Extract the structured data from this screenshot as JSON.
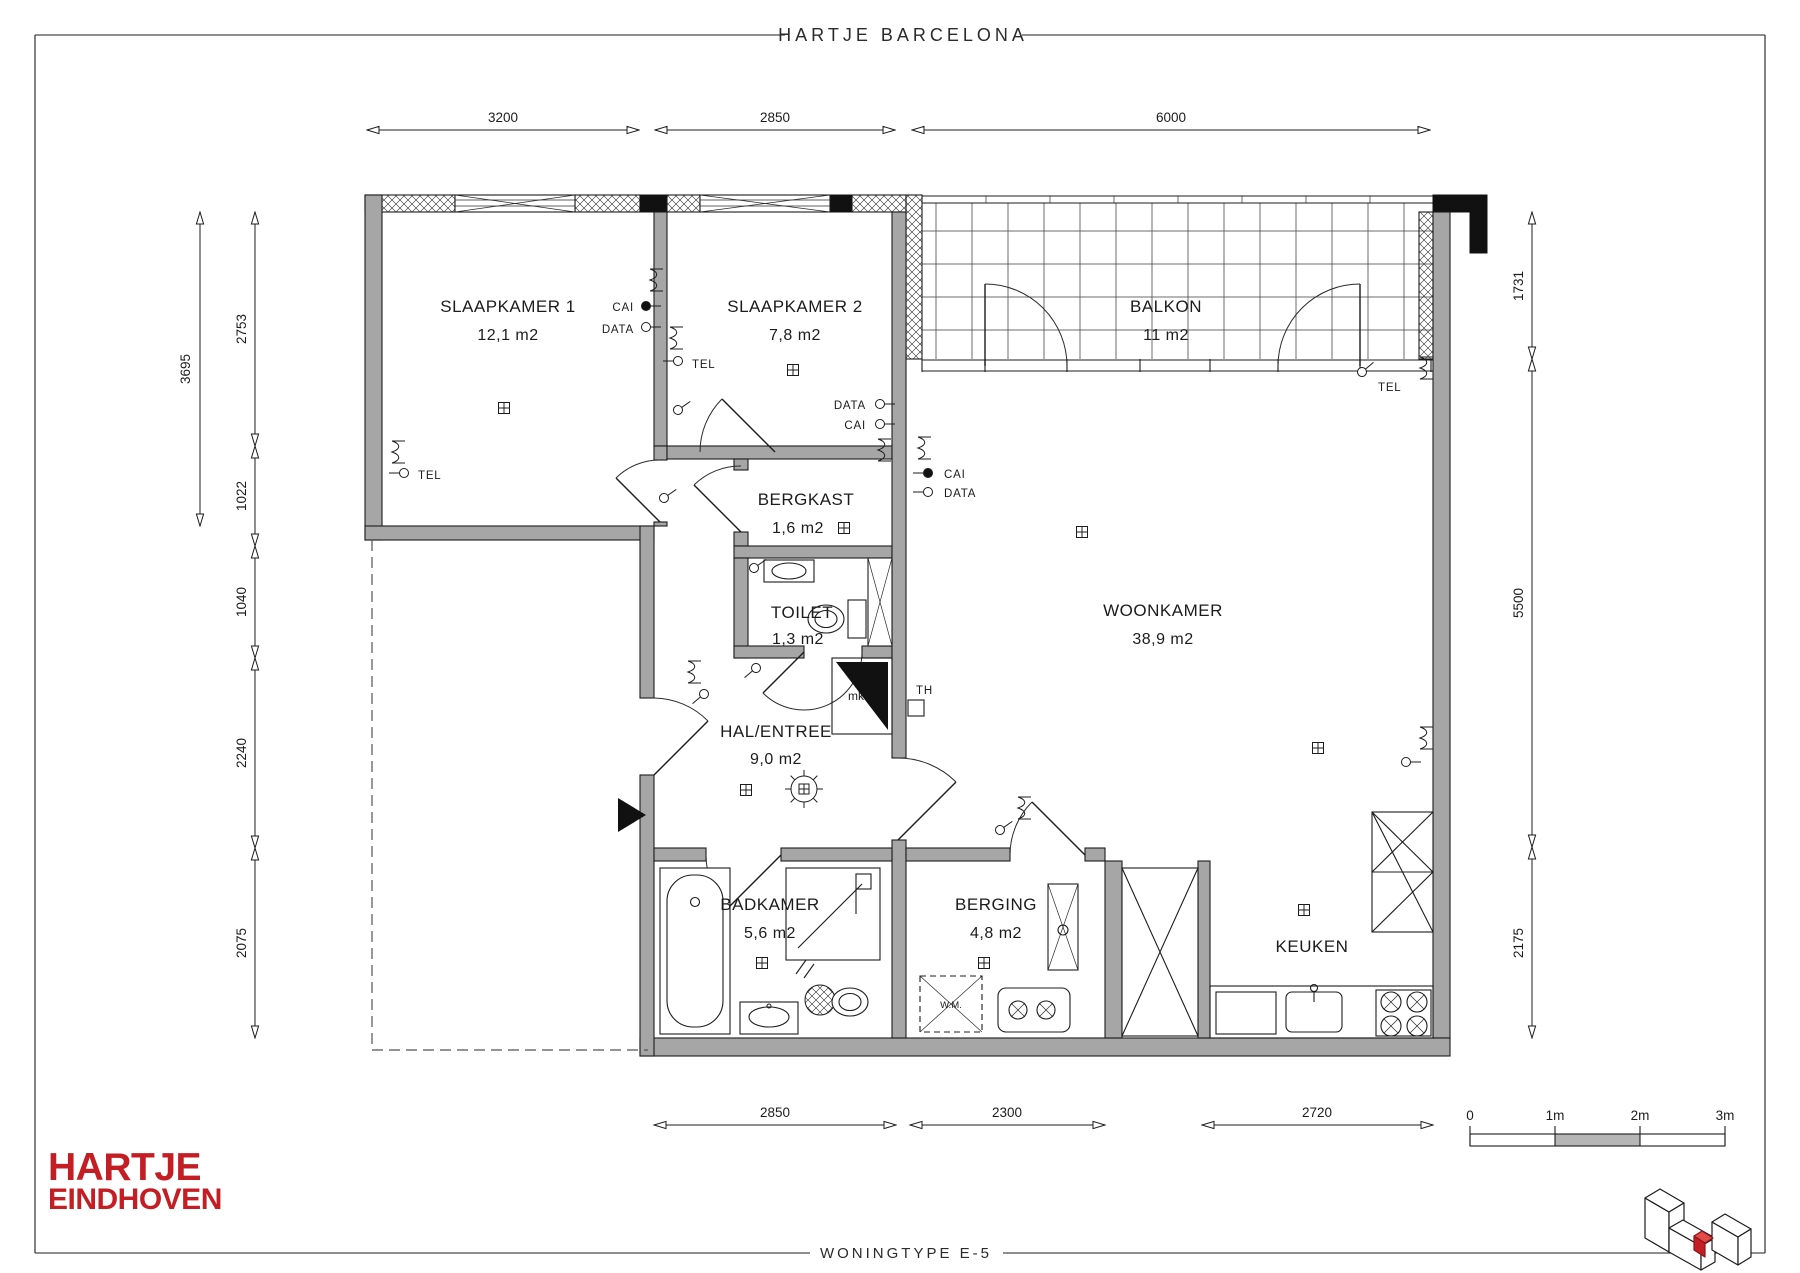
{
  "sheet": {
    "title": "HARTJE BARCELONA",
    "footer": "WONINGTYPE E-5"
  },
  "logo": {
    "line1": "HARTJE",
    "line2": "EINDHOVEN"
  },
  "rooms": {
    "slaapkamer1": {
      "name": "SLAAPKAMER 1",
      "area": "12,1 m2"
    },
    "slaapkamer2": {
      "name": "SLAAPKAMER 2",
      "area": "7,8 m2"
    },
    "balkon": {
      "name": "BALKON",
      "area": "11 m2"
    },
    "bergkast": {
      "name": "BERGKAST",
      "area": "1,6 m2"
    },
    "toilet": {
      "name": "TOILET",
      "area": "1,3 m2"
    },
    "hal": {
      "name": "HAL/ENTREE",
      "area": "9,0 m2"
    },
    "woonkamer": {
      "name": "WOONKAMER",
      "area": "38,9 m2"
    },
    "badkamer": {
      "name": "BADKAMER",
      "area": "5,6 m2"
    },
    "berging": {
      "name": "BERGING",
      "area": "4,8 m2"
    },
    "keuken": {
      "name": "KEUKEN"
    }
  },
  "dimensions": {
    "top": [
      "3200",
      "2850",
      "6000"
    ],
    "bottom": [
      "2850",
      "2300",
      "2720"
    ],
    "left_outer": "3695",
    "left": [
      "2753",
      "1022",
      "1040",
      "2240",
      "2075"
    ],
    "right": [
      "1731",
      "5500",
      "2175"
    ]
  },
  "annotations": {
    "tel": "TEL",
    "cai": "CAI",
    "data": "DATA",
    "mk": "mk",
    "th": "TH",
    "wm": "W.M."
  },
  "scalebar": {
    "labels": [
      "0",
      "1m",
      "2m",
      "3m"
    ]
  },
  "colors": {
    "wall_gray": "#a6a6a6",
    "logo_red": "#c41e24",
    "line": "#1c1c1c",
    "scale_fill": "#b5b5b5"
  }
}
